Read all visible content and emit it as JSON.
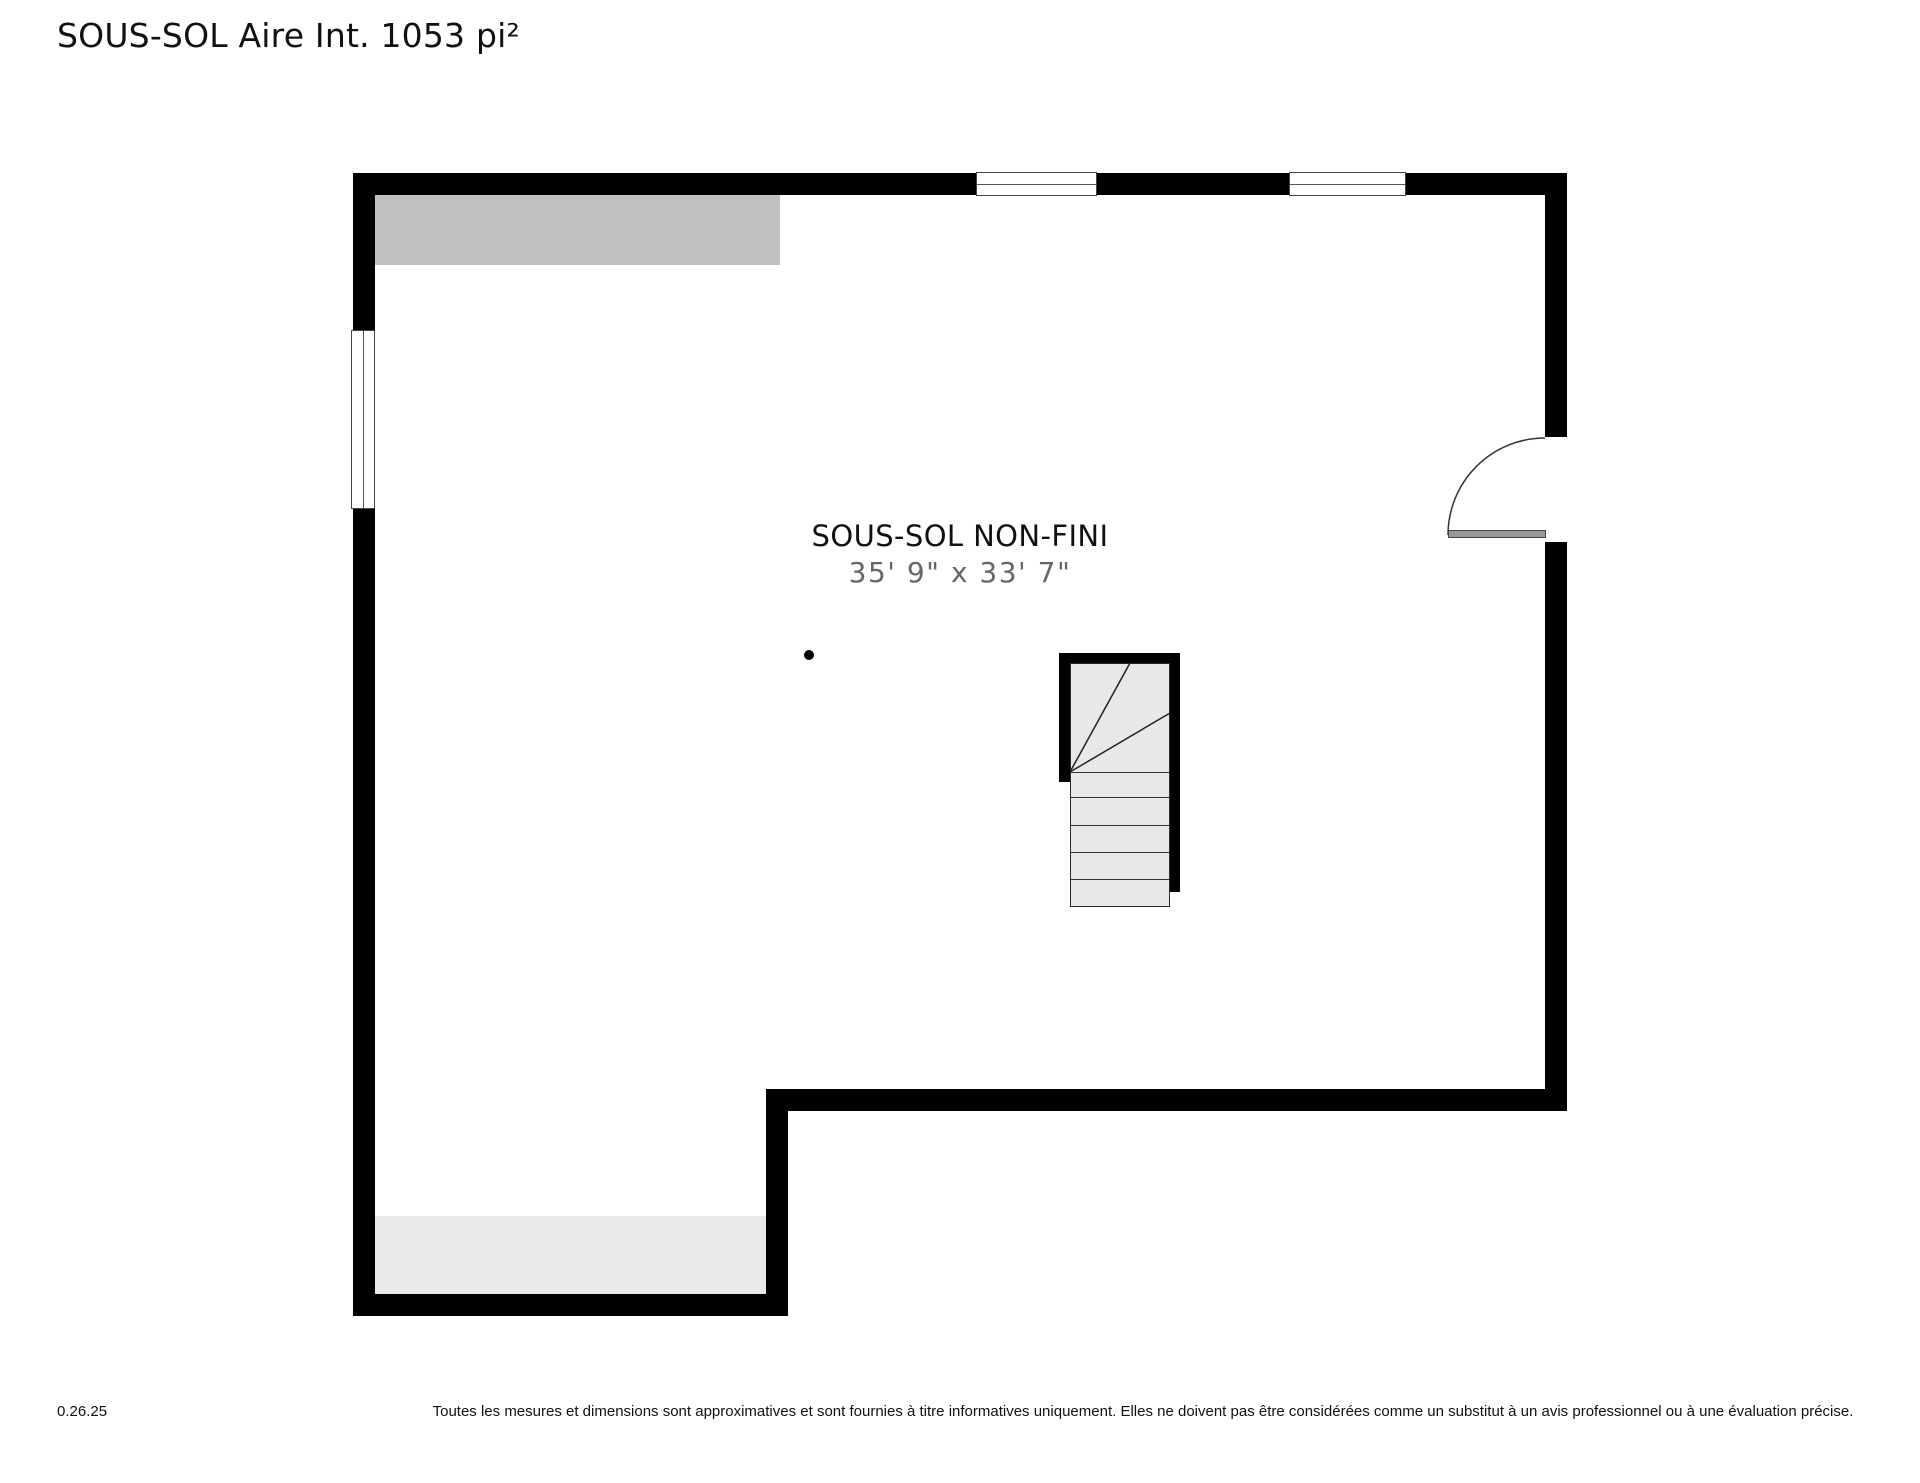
{
  "page": {
    "title": "SOUS-SOL Aire Int. 1053 pi²"
  },
  "plan": {
    "room": {
      "name": "SOUS-SOL NON-FINI",
      "dimensions": "35' 9\" x 33' 7\""
    },
    "features": {
      "windows_top": 2,
      "windows_left": 1,
      "door_right": 1,
      "stairs": 1,
      "column_dot": 1
    },
    "colors": {
      "wall": "#000000",
      "floor": "#ffffff",
      "unexcavated_area": "#c0c0c0",
      "lower_area": "#e9e9e9",
      "stair_tread": "#e8e8e8",
      "door_leaf": "#999999",
      "room_name_text": "#111111",
      "dimension_text": "#666666"
    }
  },
  "footer": {
    "version": "0.26.25",
    "disclaimer": "Toutes les mesures et dimensions sont approximatives et sont fournies à titre informatives uniquement. Elles ne doivent pas être considérées comme un substitut à un avis professionnel ou à une évaluation précise."
  }
}
